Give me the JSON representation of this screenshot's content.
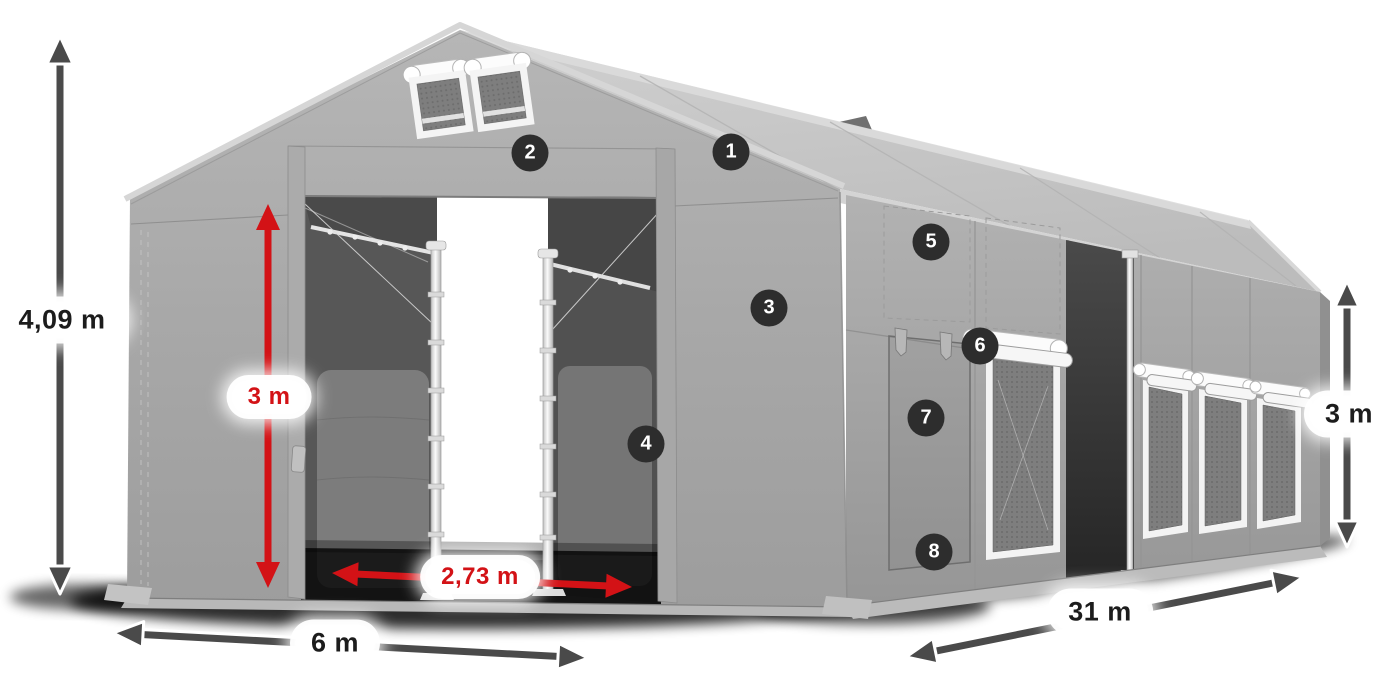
{
  "measurements": {
    "total_height": {
      "text": "4,09 m",
      "style": "dark"
    },
    "entrance_height": {
      "text": "3 m",
      "style": "red"
    },
    "entrance_width": {
      "text": "2,73 m",
      "style": "red"
    },
    "width": {
      "text": "6 m",
      "style": "dark"
    },
    "length": {
      "text": "31 m",
      "style": "dark"
    },
    "side_height": {
      "text": "3 m",
      "style": "dark"
    }
  },
  "hotspots": [
    {
      "label": "1"
    },
    {
      "label": "2"
    },
    {
      "label": "3"
    },
    {
      "label": "4"
    },
    {
      "label": "5"
    },
    {
      "label": "6"
    },
    {
      "label": "7"
    },
    {
      "label": "8"
    }
  ],
  "colors": {
    "background": "#ffffff",
    "annotation_red": "#d31216",
    "arrow_dark": "#4a4a4a",
    "badge_bg": "#2d2d2d",
    "pill_bg": "#ffffff",
    "pill_text": "#1c1c1c",
    "tent_gray": "#a8a8a8",
    "roof_gray": "#c6c6c6",
    "interior_gray": "#5e5e5e"
  }
}
